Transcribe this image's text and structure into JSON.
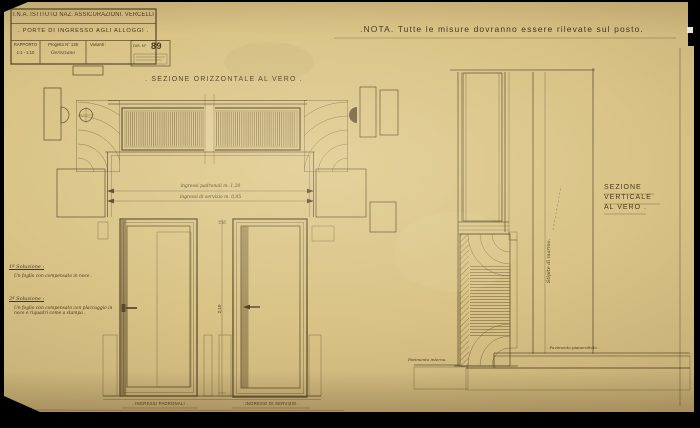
{
  "title_block": {
    "org": "I.N.A. ISTITUTO NAZ. ASSICURAZIONI. VERCELLI",
    "subject": ". PORTE DI INGRESSO AGLI ALLOGGI .",
    "rapporto_label": "RAPPORTO",
    "rapporto_value": "1:1 - 1:10",
    "progetto_label": "Progetto N° 138",
    "progetto_value": "Gerezzano",
    "varianti_label": "Varianti :",
    "dis_label": "DIS. N°",
    "dis_value": "89"
  },
  "nota": ".NOTA.  Tutte le misure dovranno essere rilevate sul posto.",
  "sections": {
    "horizontal_title": ". SEZIONE ORIZZONTALE AL VERO .",
    "vertical_title_lines": [
      "SEZIONE",
      "VERTICALE",
      "AL VERO ."
    ]
  },
  "dimensions": {
    "width_padronali": "ingressi padronali m. 1,20",
    "width_servizio": "ingressi di servizio m. 0,85",
    "door_height": "2,10"
  },
  "solution_notes": {
    "sol1_title": "1ª Soluzione :",
    "sol1_body": "Un foglio con compensato in noce .",
    "sol2_title": "2ª Soluzione :",
    "sol2_body": "Un foglio con compensato con placcaggio in noce e riquadri come a stampa ."
  },
  "labels": {
    "door_left": ". INGRESSI PADRONALI .",
    "door_right": ". INGRESSI DI SERVIZIO .",
    "jamb_marble": "Stipite di marmo.",
    "floor_interior": "Pavimento interno.",
    "floor_landing": ". Pavimento pianerottolo ."
  },
  "colors": {
    "paper": "#d9c386",
    "paper_light": "#e6d39f",
    "paper_dark": "#c4a96a",
    "ink": "#4a3a22",
    "background": "#000000"
  }
}
